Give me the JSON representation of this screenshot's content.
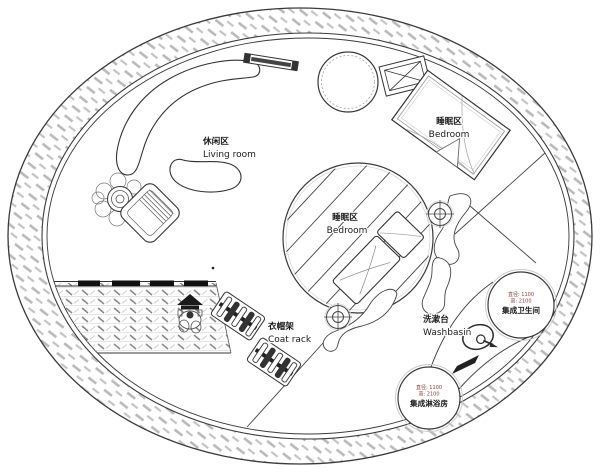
{
  "plan": {
    "areas": {
      "living_room": {
        "zh": "休闲区",
        "en": "Living room"
      },
      "bedroom_upper": {
        "zh": "睡眠区",
        "en": "Bedroom"
      },
      "bedroom_center": {
        "zh": "睡眠区",
        "en": "Bedroom"
      },
      "coat_rack": {
        "zh": "衣帽架",
        "en": "Coat rack"
      },
      "washbasin": {
        "zh": "洗漱台",
        "en": "Washbasin"
      }
    },
    "pods": {
      "toilet": {
        "spec_diameter": "直径: 1100",
        "spec_height": "高: 2100",
        "name": "集成卫生间"
      },
      "shower": {
        "spec_diameter": "直径: 1100",
        "spec_height": "高: 2100",
        "name": "集成淋浴房"
      }
    },
    "colors": {
      "line": "#3a3a3a",
      "wall_hatch": "#b9b9b9",
      "deck_tick": "#8a8a8a",
      "pod_spec_text": "#8d3b34",
      "background": "#ffffff"
    }
  }
}
